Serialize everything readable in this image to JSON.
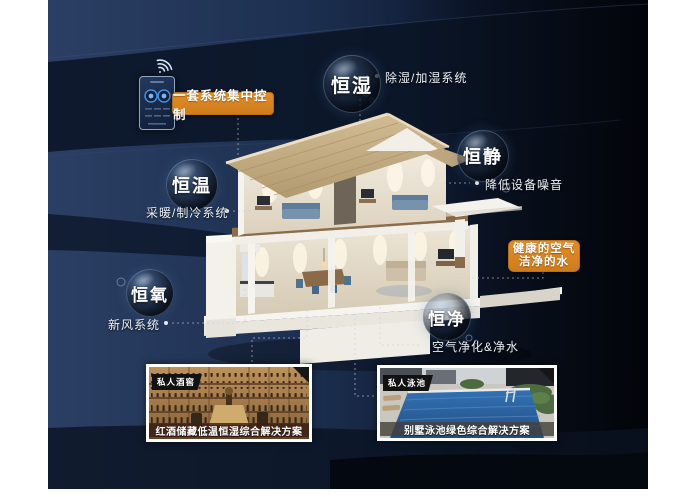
{
  "badges": {
    "control": "一套系统集中控制",
    "health": [
      "健康的空气",
      "洁净的水"
    ]
  },
  "bubbles": [
    {
      "label": "恒湿",
      "caption": "除湿/加湿系统"
    },
    {
      "label": "恒静",
      "caption": "降低设备噪音"
    },
    {
      "label": "恒温",
      "caption": "采暖/制冷系统"
    },
    {
      "label": "恒氧",
      "caption": "新风系统"
    },
    {
      "label": "恒净",
      "caption": "空气净化&净水"
    }
  ],
  "cards": [
    {
      "tag": "私人酒窖",
      "caption": "红酒储藏低温恒湿综合解决方案"
    },
    {
      "tag": "私人泳池",
      "caption": "别墅泳池绿色综合解决方案"
    }
  ],
  "colors": {
    "accent_orange": "#dd861f",
    "background_navy": "#1e3153",
    "background_dark": "#070c16"
  }
}
